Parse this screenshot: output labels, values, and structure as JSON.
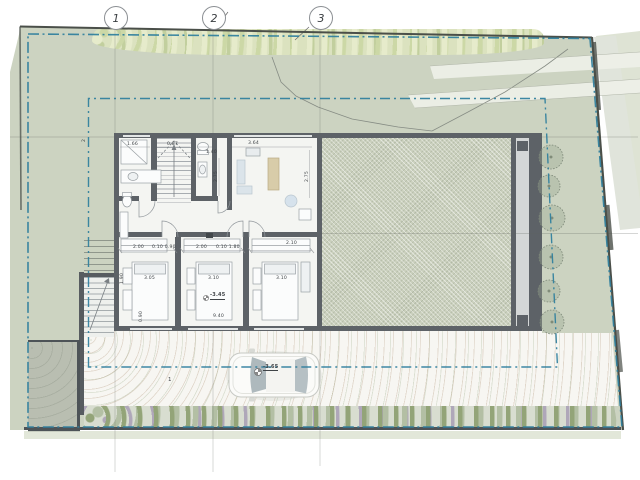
{
  "grid": {
    "bubbles": [
      {
        "label": "1"
      },
      {
        "label": "2"
      },
      {
        "label": "3"
      }
    ]
  },
  "levels": {
    "room": "-3.45",
    "yard": "-3.65"
  },
  "annotations": {
    "parking_stall": "1",
    "boundary_mark": "2"
  },
  "dims": {
    "bath_w": "1.66",
    "stair_w": "0.87",
    "wc_w": "1.40",
    "wc_d": "2.75",
    "living_w": "3.64",
    "living_d": "2.75",
    "c1": "2.00",
    "c2": "0.10 0.90",
    "c3": "2.00",
    "c4": "0.10 1.80",
    "c5": "2.10",
    "r1": "3.05",
    "r2": "3.10",
    "r3": "3.10",
    "v1": "1.90",
    "v2": "0.90",
    "total": "9.40"
  },
  "colors": {
    "boundary": "#2e7f9e",
    "wall": "#5d6267",
    "grass": "#ccd3c1",
    "hatch": "#cad0bd",
    "interior": "#f4f5f2",
    "paving": "#f7f6f2"
  }
}
